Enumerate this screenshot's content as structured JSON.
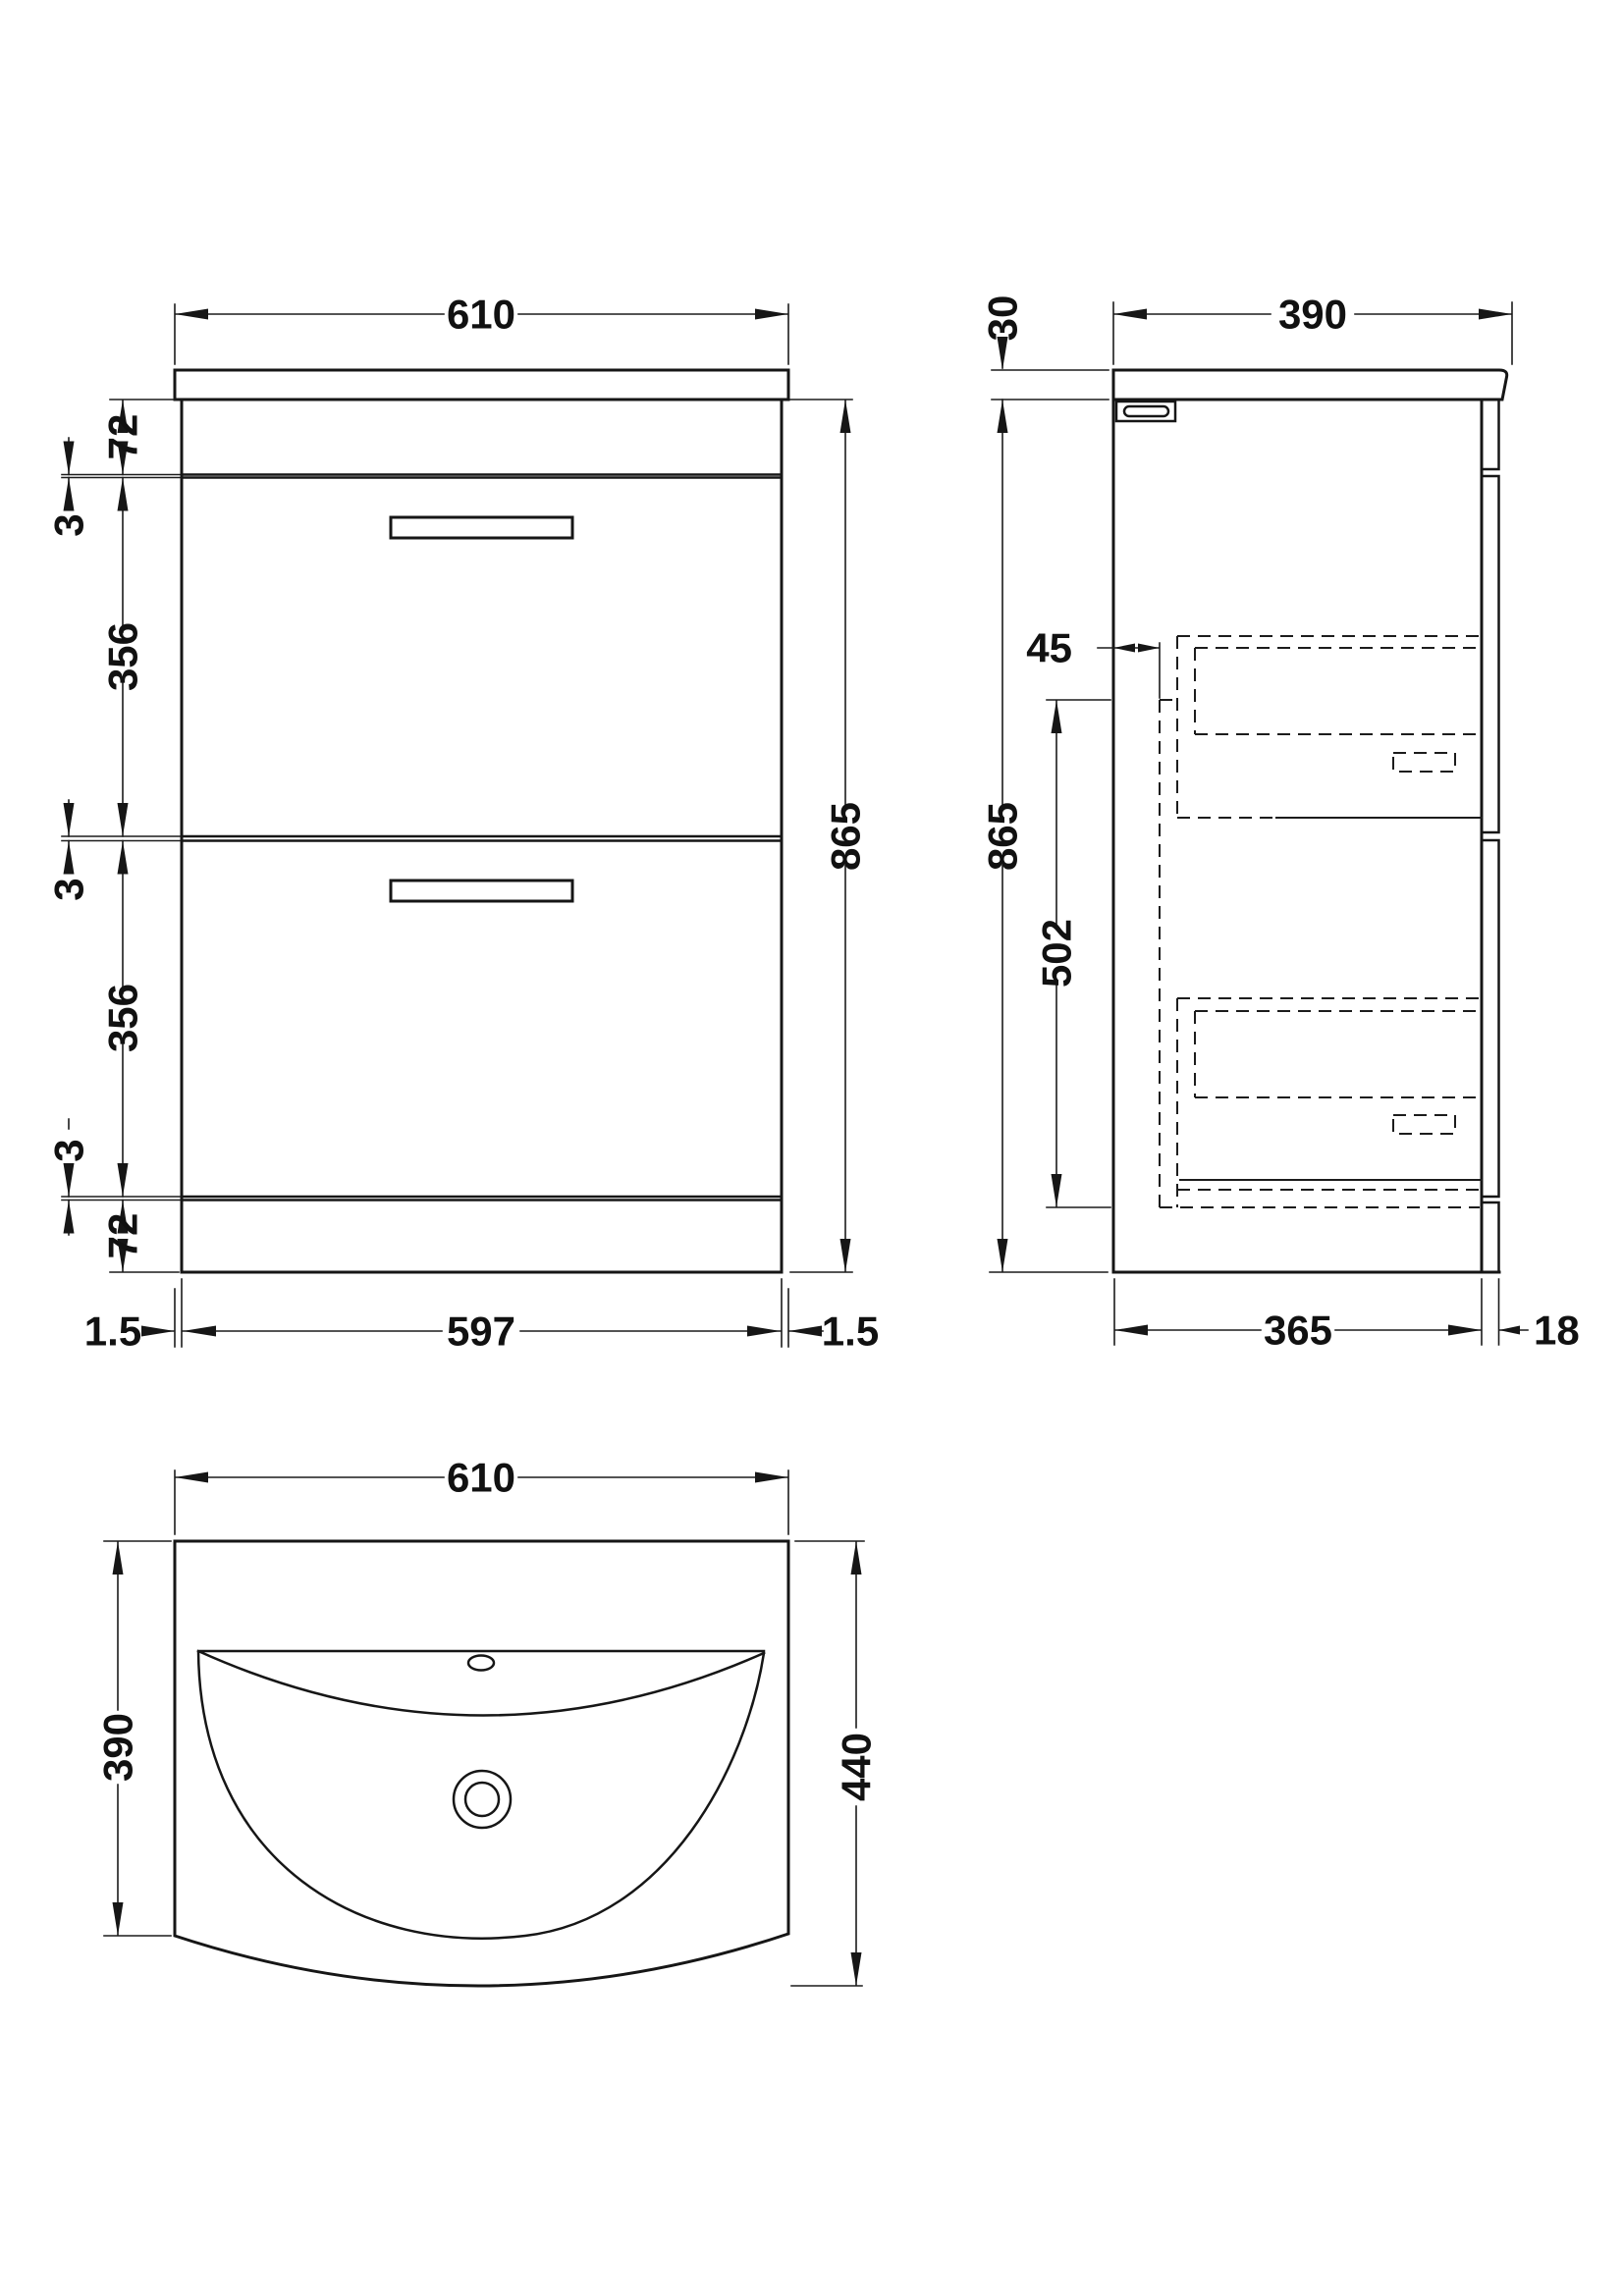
{
  "drawing": {
    "type": "technical-dimension-diagram",
    "subject": "vanity unit with basin - 2 drawer floor standing",
    "background_color": "#ffffff",
    "line_color": "#161616",
    "views": {
      "front": {
        "name": "front elevation",
        "width_top": "610",
        "height": "865",
        "top_rail": "72",
        "gap_top": "3",
        "drawer_upper": "356",
        "gap_mid": "3",
        "drawer_lower": "356",
        "gap_bottom": "3",
        "plinth": "72",
        "overhang_left": "1.5",
        "body_width": "597",
        "overhang_right": "1.5"
      },
      "side": {
        "name": "side elevation",
        "depth_top": "390",
        "worktop": "30",
        "height": "865",
        "back_gap": "45",
        "box_span": "502",
        "body_depth": "365",
        "front_thickness": "18"
      },
      "plan": {
        "name": "plan view",
        "width": "610",
        "basin_depth": "390",
        "overall_depth": "440"
      }
    }
  }
}
